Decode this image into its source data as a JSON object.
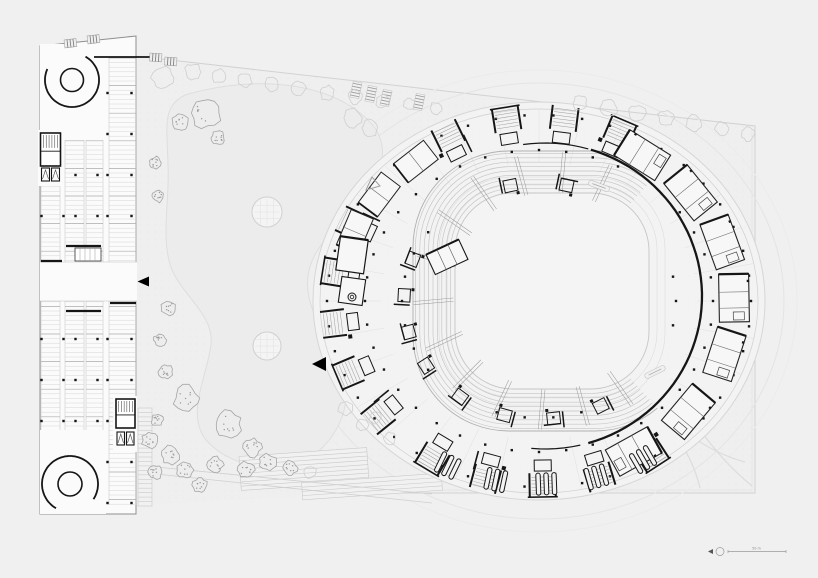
{
  "drawing": {
    "kind": "architectural-site-plan",
    "elements": {
      "parking_building": "multi-bay parking structure with two spiral ramps and stair cores",
      "stadium": "oval arena with concourse ring, seating bowl and central field",
      "landscape": "lawn, tree rows, garden steps and paths"
    }
  },
  "scale_bar": {
    "label": "50 m"
  },
  "icons": {
    "north_arrow": "triangle-with-circle",
    "entrance_marker_west": "filled-left-triangle",
    "entrance_marker_plaza": "filled-left-triangle",
    "site_marker": "outline-triangle"
  },
  "palette": {
    "bg": "#f0f0f1",
    "paper": "#fbfbfb",
    "ink": "#161616",
    "line_dark": "#8f8f8f",
    "line_mid": "#b9b9b9",
    "line_light": "#d6d6d6",
    "line_faint": "#e3e3e3",
    "site_fill": "#efefef",
    "plaza_fill": "#f3f3f3",
    "lawn_fill": "#ececec",
    "field_fill": "#f4f4f4",
    "tree_ghost": "#cfcfcf",
    "tree_dark": "#a5a5a5",
    "text": "#8a8a8a"
  }
}
